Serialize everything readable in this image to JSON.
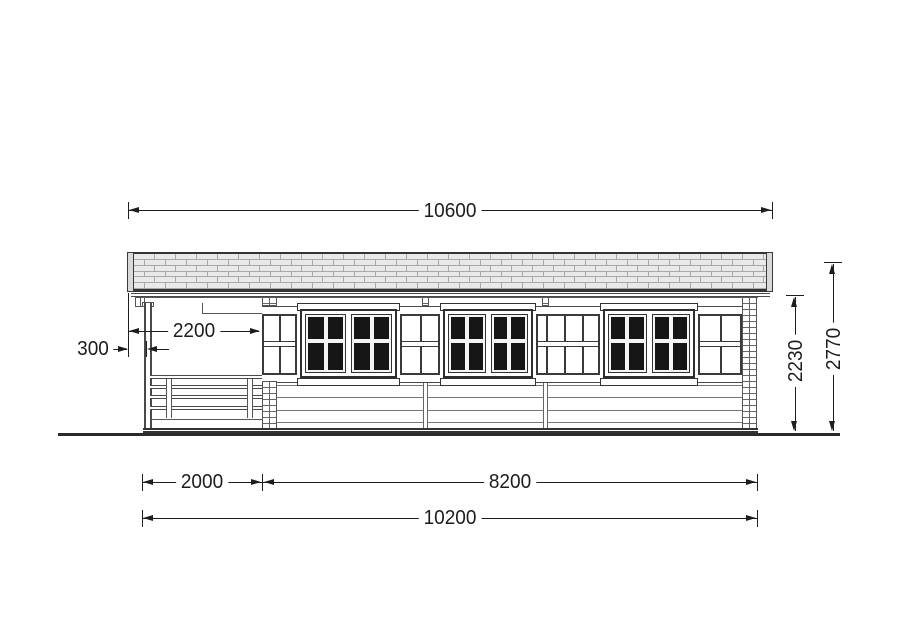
{
  "drawing": {
    "type": "log-cabin-side-elevation",
    "dimensions": {
      "roof_width": "10600",
      "porch_depth": "2200",
      "overhang": "300",
      "wall_height": "2230",
      "total_height": "2770",
      "terrace_width": "2000",
      "cabin_width": "8200",
      "base_total_width": "10200"
    },
    "colors": {
      "dim": "#1d1d1d",
      "glass": "#161616",
      "roof_fill": "#e9e9e9",
      "roof_line": "#a8a8a8",
      "ground": "#2b2b2b"
    }
  }
}
